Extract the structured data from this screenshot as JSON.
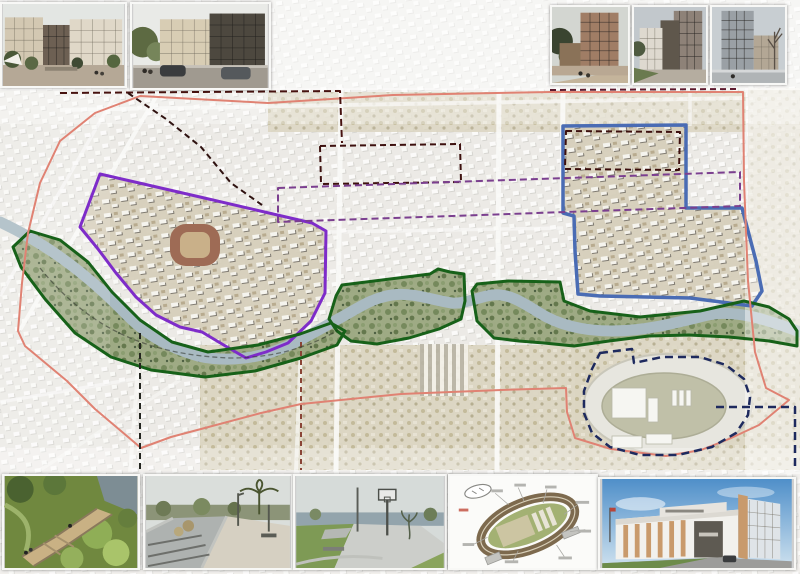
{
  "poster": {
    "title": "city-riverfront-masterplan-poster",
    "canvas": {
      "width": 800,
      "height": 574
    }
  },
  "map": {
    "base_color": "#edebe7",
    "river_color": "#a9bac2",
    "river_path": "M0,222 C30,236 55,252 80,272 C100,288 112,300 128,316 C148,336 170,348 198,356 C220,361 248,360 272,352 C298,343 318,330 340,318 C360,307 372,298 392,295 C412,292 432,300 452,303 C466,304 478,297 492,295 C508,293 522,302 538,312 C558,325 584,331 612,331 C648,331 678,322 708,315 C736,309 768,320 800,332",
    "overlays": [
      {
        "name": "purple-project-boundary",
        "color": "#7e2cc9",
        "width": 3,
        "dash": "",
        "fill": "tan",
        "d": "M100,174 L200,197 L312,223 L326,231 L325,293 L311,321 L288,343 L266,352 L246,358 L222,344 L202,332 L180,327 L156,315 L136,297 L116,273 L98,249 L80,227 Z"
      },
      {
        "name": "blue-project-boundary",
        "color": "#4a6cb4",
        "width": 3.5,
        "dash": "",
        "fill": "tan",
        "d": "M563,126 L686,125 L686,208 L742,208 L756,261 L762,291 L752,306 L690,298 L600,296 L578,294 L575,251 L574,216 L563,213 Z"
      },
      {
        "name": "green-riverfront-west",
        "color": "#176119",
        "width": 3,
        "dash": "",
        "fill": "park",
        "d": "M30,231 L60,240 L88,262 L112,292 L140,320 L172,342 L208,352 L258,345 L300,334 L331,323 L345,331 L337,345 L301,358 L255,371 L205,377 L151,370 L111,357 L75,333 L45,299 L21,267 L13,247 Z"
      },
      {
        "name": "green-riverfront-center",
        "color": "#176119",
        "width": 3,
        "dash": "",
        "fill": "park",
        "d": "M336,296 L342,285 L430,274 L438,269 L450,272 L464,274 L465,301 L461,319 L439,329 L409,338 L377,344 L351,341 L337,331 L329,319 Z"
      },
      {
        "name": "green-riverfront-east",
        "color": "#176119",
        "width": 3,
        "dash": "",
        "fill": "park",
        "d": "M472,291 L477,284 L508,281 L560,282 L564,301 L590,311 L640,317 L700,311 L744,301 L769,307 L789,319 L797,331 L797,346 L769,341 L729,337 L689,335 L649,336 L609,341 L574,346 L544,343 L519,341 L494,338 L477,321 Z"
      },
      {
        "name": "red-district-boundary",
        "color": "#e08273",
        "width": 2,
        "dash": "",
        "fill": "none",
        "d": "M743,92 L550,92 L393,95 L268,103 L140,96 L95,113 L60,141 L40,183 L28,233 L22,283 L18,331 L25,346 L67,381 L95,409 L121,431 L141,448 L171,437 L201,429 L261,413 L301,404 L401,394 L501,390 L566,388 L567,412 L575,438 L611,449 L666,456 L701,450 L729,439 L759,425 L789,400 L766,388 L755,352 L748,281 L744,181 Z"
      },
      {
        "name": "maroon-dashed-north",
        "color": "#47120f",
        "width": 2,
        "dash": "7 4",
        "fill": "none",
        "d": "M60,93 L200,92 L340,91 L342,143"
      },
      {
        "name": "maroon-dashed-diagonal",
        "color": "#2f1210",
        "width": 2,
        "dash": "6 4",
        "fill": "none",
        "d": "M128,93 L166,119 L201,147 L231,183 L262,205"
      },
      {
        "name": "maroon-dashed-top-east",
        "color": "#5c1a2e",
        "width": 2,
        "dash": "6 4",
        "fill": "none",
        "d": "M550,90 L740,89"
      },
      {
        "name": "maroon-dashed-block-a",
        "color": "#3d100e",
        "width": 2,
        "dash": "6 4",
        "fill": "none",
        "d": "M320,146 L460,144 L461,182 L321,184 Z"
      },
      {
        "name": "maroon-dashed-block-b",
        "color": "#3d100e",
        "width": 2,
        "dash": "6 4",
        "fill": "none",
        "d": "M566,131 L680,132 L679,170 L565,169 Z"
      },
      {
        "name": "purple-dashed-zone",
        "color": "#7b3f8f",
        "width": 2,
        "dash": "7 4",
        "fill": "none",
        "d": "M278,188 L740,172 L740,206 L278,222 Z"
      },
      {
        "name": "navy-dashed-velodrome",
        "color": "#1e2a5e",
        "width": 2.5,
        "dash": "8 5",
        "fill": "none",
        "d": "M600,353 L632,349 L634,363 L662,357 L700,357 L726,365 L744,379 L750,397 L748,415 L736,433 L712,447 L678,455 L640,455 L610,447 L592,433 L584,413 L584,391 L592,369 Z"
      },
      {
        "name": "navy-dashed-link",
        "color": "#1e2a5e",
        "width": 2.5,
        "dash": "8 5",
        "fill": "none",
        "d": "M716,407 L795,407 L795,466"
      },
      {
        "name": "black-dashed-west",
        "color": "#23251f",
        "width": 2,
        "dash": "6 4",
        "fill": "none",
        "d": "M140,333 L140,470"
      },
      {
        "name": "brown-dashed-center",
        "color": "#8a4436",
        "width": 2,
        "dash": "5 4",
        "fill": "none",
        "d": "M301,342 L301,470"
      },
      {
        "name": "black-dashed-river-path",
        "color": "#2c2f28",
        "width": 1.3,
        "dash": "5 3",
        "fill": "none",
        "opacity": 0.55,
        "d": "M40,268 C90,330 150,355 230,358 C280,358 315,344 338,330"
      }
    ]
  },
  "thumbnails": {
    "top_left": [
      {
        "id": "render-courtyard-residential"
      },
      {
        "id": "render-street-residential"
      }
    ],
    "top_right": [
      {
        "id": "render-brick-tower"
      },
      {
        "id": "render-midrise-dusk"
      },
      {
        "id": "render-tower-street"
      }
    ],
    "bottom": [
      {
        "id": "photo-park-boardwalk"
      },
      {
        "id": "photo-river-walkway"
      },
      {
        "id": "photo-skatepark-basketball"
      },
      {
        "id": "diagram-velodrome-plan"
      },
      {
        "id": "render-velodrome-building"
      }
    ]
  }
}
